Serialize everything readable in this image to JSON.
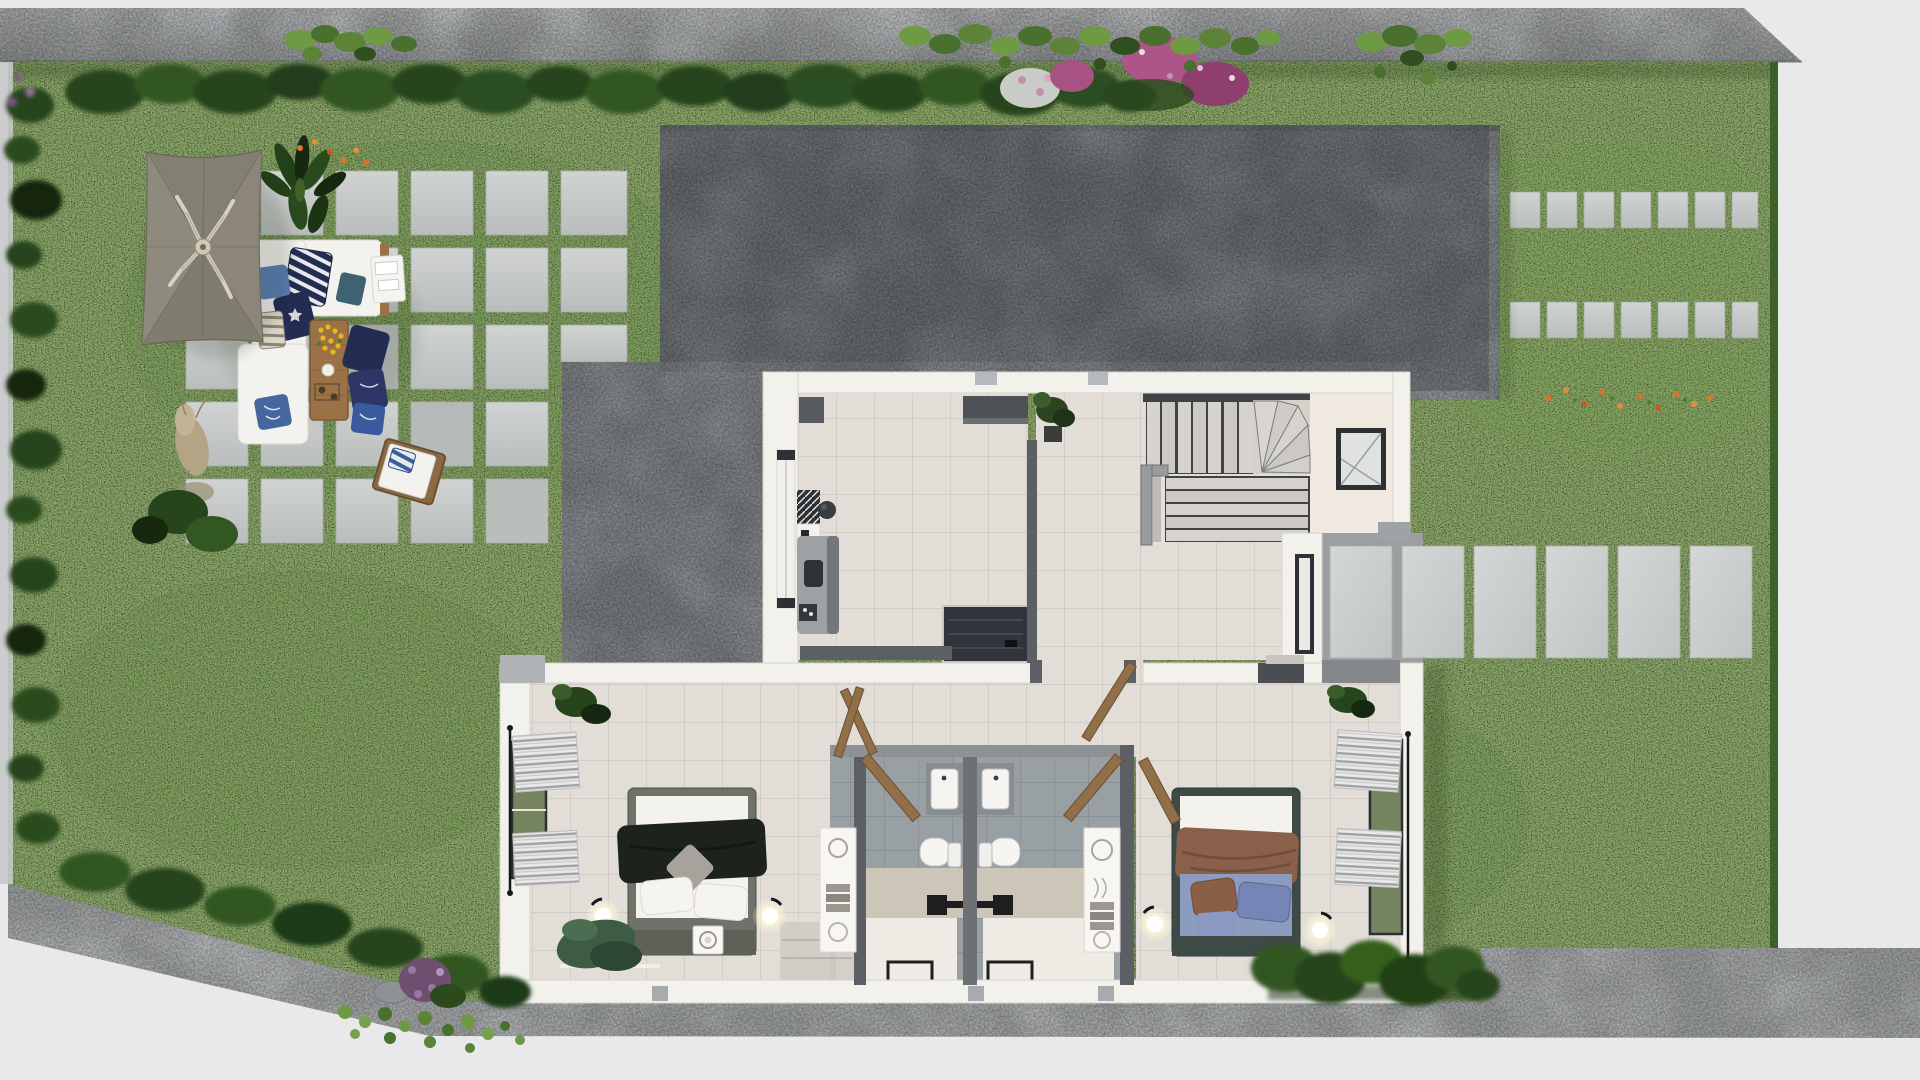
{
  "scene": {
    "title": "Top-down 3D render — upper floor plan with garden",
    "description": "Aerial 3D rendering of a house upper floor set in a lawn garden: patio with cantilever umbrella and white outdoor sofa set on concrete pavers, large gray flat roof slab, interior with living area, L-shaped staircase, landing, two bedrooms flanking twin bathrooms, entrance stepping-stone path, boundary walls and walkways.",
    "rooms": [
      "Living area",
      "Hallway",
      "Staircase",
      "Landing",
      "Entrance porch",
      "Bathroom left",
      "Bathroom right",
      "Bedroom left",
      "Bedroom right"
    ],
    "garden": [
      "lawn",
      "hedge rows",
      "patio pavers",
      "cantilever umbrella",
      "outdoor sofa set",
      "coffee table",
      "sun lounger",
      "stepping stones",
      "flower beds",
      "boundary walkway"
    ]
  },
  "colors": {
    "background": "#e9e9eb",
    "boundary_wall": "#b3b6b8",
    "walkway": "#c0c3c5",
    "lawn": "#5e8e3a",
    "hedge_dark": "#27451c",
    "hedge_mid": "#335722",
    "plant_bright": "#6d9a43",
    "flower_orange": "#d9742a",
    "flower_yellow": "#e8b822",
    "flower_magenta": "#a85284",
    "roof": "#7d8286",
    "roof_edge": "#9aa0a3",
    "terrace": "#95999c",
    "paver": "#c6c9c7",
    "wall_white": "#f3f1ec",
    "tile": "#e2ded7",
    "tile_line": "#cbc7c0",
    "partition": "#5c6064",
    "console": "#4e5256",
    "bath_tile": "#99a0a4",
    "bath_band": "#cfc8bb",
    "shower_tray": "#eeebe5",
    "vanity": "#878d91",
    "stair_tread": "#d6d3cc",
    "stair_dark": "#3f4347",
    "railing": "#989c9f",
    "landing_floor": "#efe9df",
    "void_dark": "#31343a",
    "door_wood": "#916f49",
    "window_frame": "#2e3134",
    "glass_green": "#76855f",
    "umbrella": "#8b8679",
    "umbrella_rib": "#d8d1be",
    "sofa_white": "#f3f2ef",
    "cushion_navy": "#232c52",
    "cushion_blue": "#5d7fb5",
    "cushion_teal": "#3f6273",
    "wood": "#9a7246",
    "bed_frame_left": "#6e7268",
    "bed_throw_left": "#1d221c",
    "bed_frame_right": "#3e4a46",
    "bed_blanket_brown": "#8a604a",
    "bed_sheet_blue": "#8c9cbe",
    "pillow_blue": "#7585b5",
    "lamp_glow": "#fff6d8",
    "rug_dark": "#2e3134"
  }
}
